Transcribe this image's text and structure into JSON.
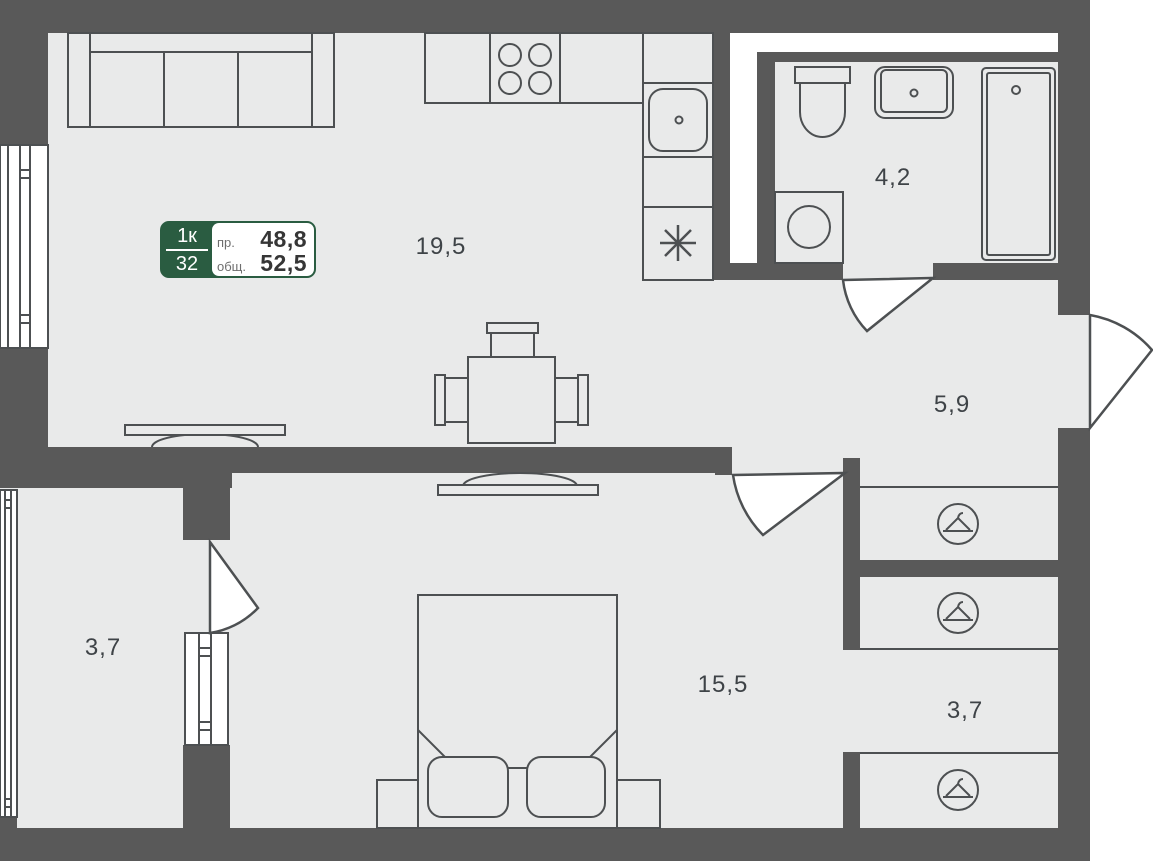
{
  "badge": {
    "rooms_label": "1к",
    "floor_number": "32",
    "living_label": "пр.",
    "living_area": "48,8",
    "total_label": "общ.",
    "total_area": "52,5",
    "accent_green": "#2A5C41"
  },
  "rooms": [
    {
      "name": "kitchen-living-room",
      "area": "19,5"
    },
    {
      "name": "bathroom",
      "area": "4,2"
    },
    {
      "name": "hallway",
      "area": "5,9"
    },
    {
      "name": "balcony",
      "area": "3,7"
    },
    {
      "name": "bedroom",
      "area": "15,5"
    },
    {
      "name": "wardrobe",
      "area": "3,7"
    }
  ],
  "icons": {
    "wardrobe": "hanger-icon",
    "fridge": "asterisk-icon"
  },
  "colors": {
    "wall": "#595959",
    "floor": "#e9eaea",
    "line": "#4d5052",
    "background": "#ffffff"
  }
}
